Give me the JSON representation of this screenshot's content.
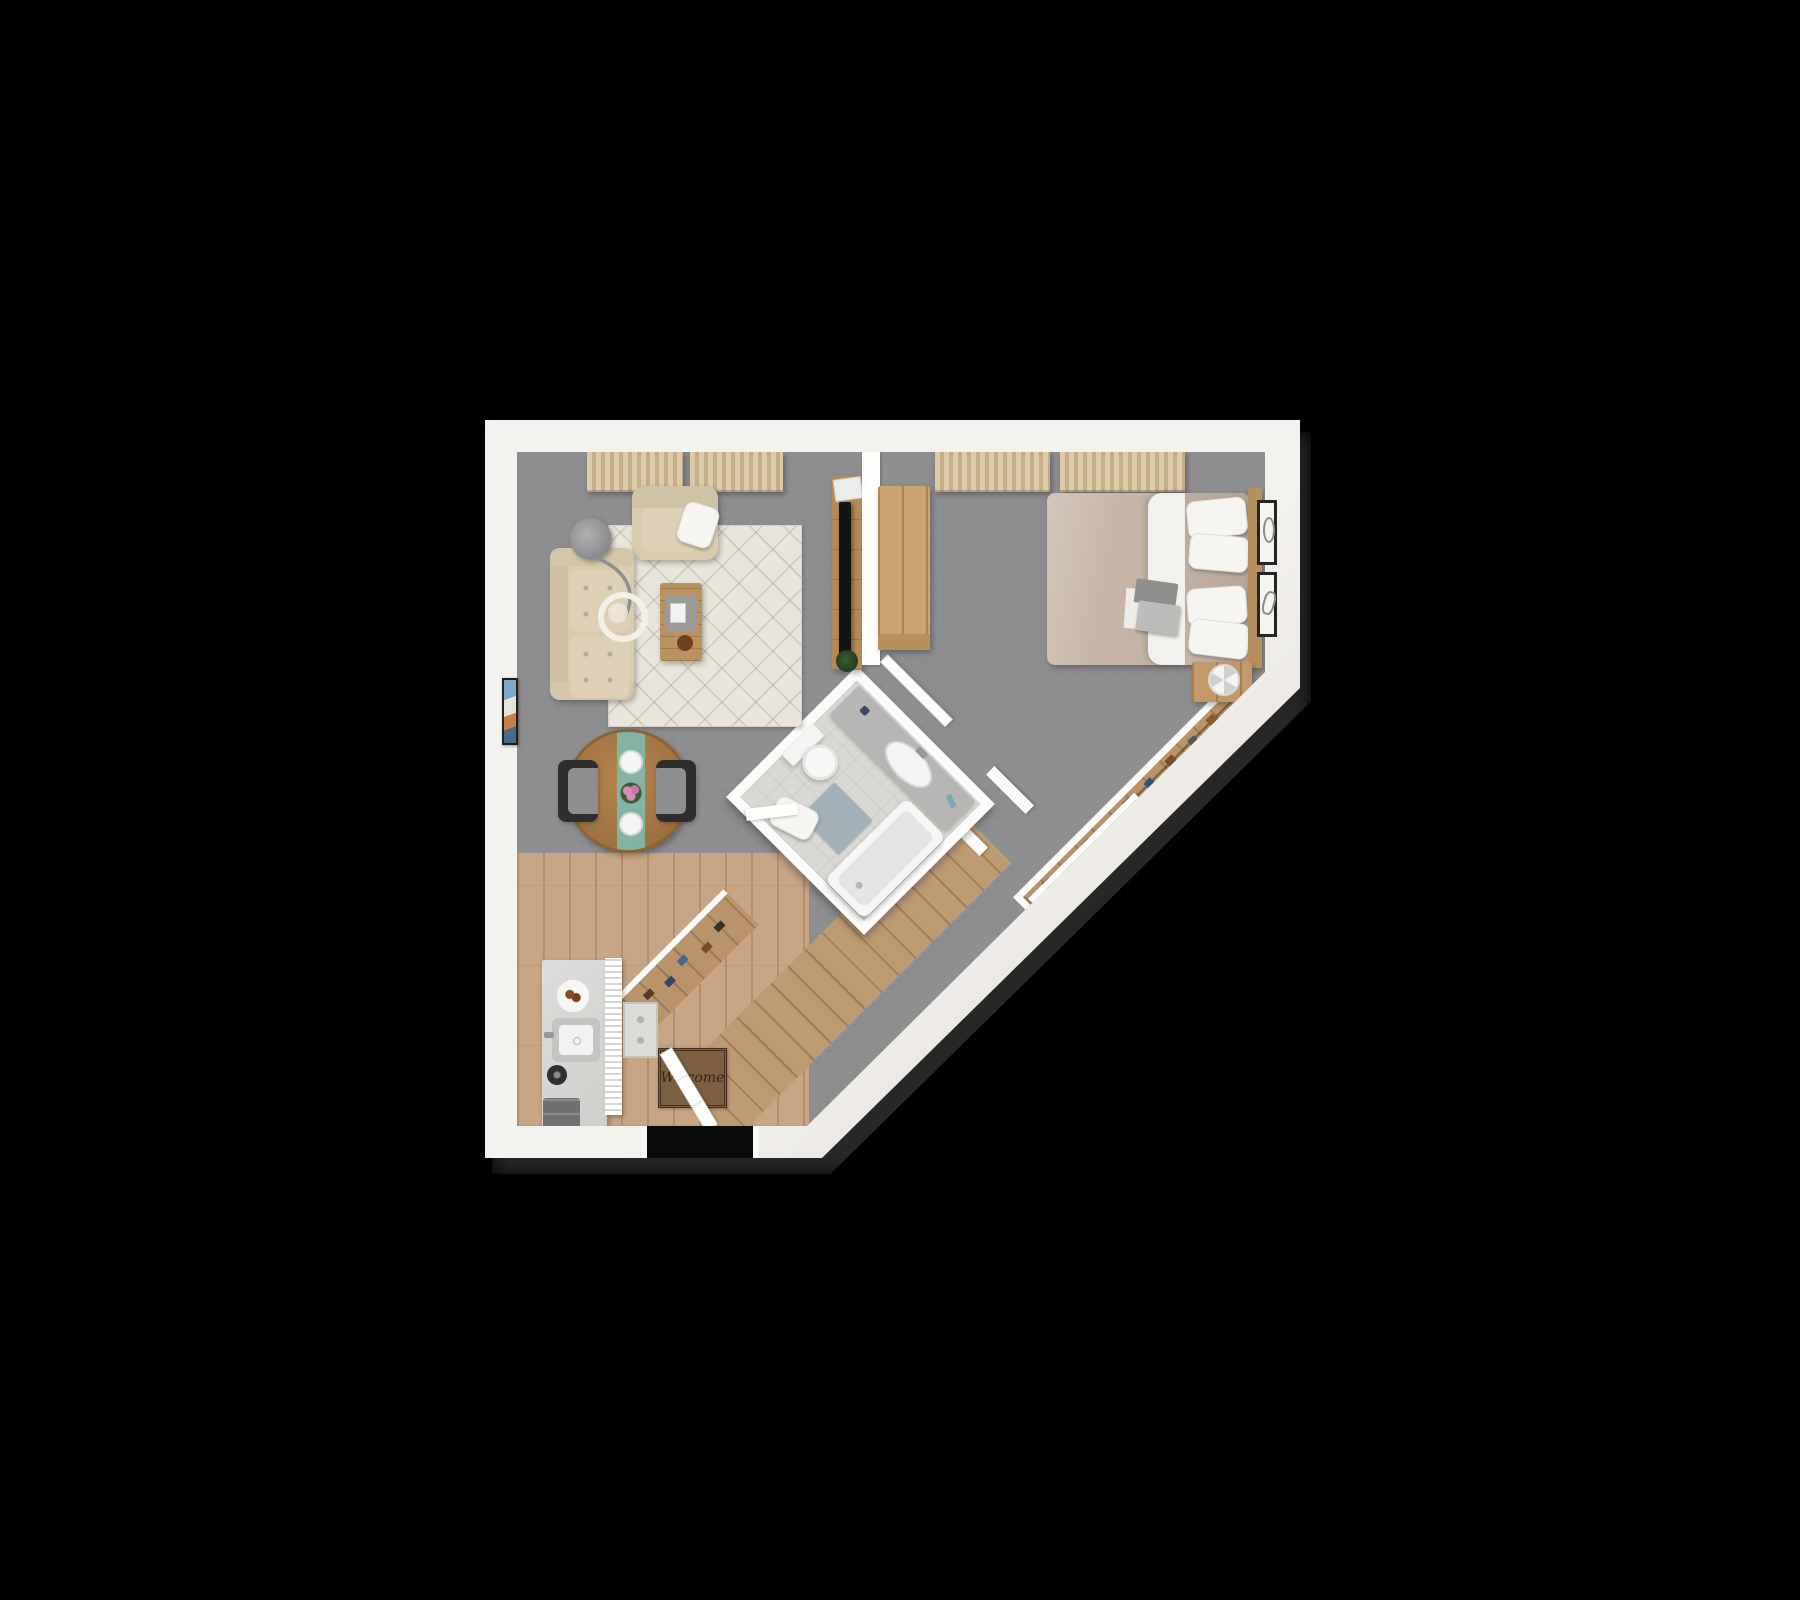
{
  "scene": {
    "type": "3d-floorplan-top-view-render",
    "background_color": "#000000"
  },
  "labels": {
    "welcome_mat": "Welcome"
  },
  "palette": {
    "background": "#000000",
    "exterior_wall": "#f2f0ec",
    "interior_wall": "#fdfdfb",
    "carpet": "#8e8e90",
    "wood_floor": "#c7a585",
    "area_rug": "#e9e5da",
    "sofa": "#d8cbae",
    "curtain": "#d8c5a3",
    "dining_table": "#a97c4a",
    "table_runner": "#7fb9ae",
    "coffee_table": "#b9925f",
    "bed_duvet": "#c6b5a6",
    "pillow": "#f6f5f2",
    "headboard": "#b68f5e",
    "desk": "#c9a46e",
    "closet_wood": "#b9946a",
    "bathroom_tile": "#d9d8d4",
    "bathtub": "#f5f5f3",
    "bath_mat": "#a4b0b8",
    "welcome_mat": "#7d5f42"
  },
  "rooms": [
    {
      "name": "living-room",
      "floor": "carpet",
      "furniture": [
        "sofa",
        "armchair",
        "throw-pillow",
        "floor-lamp",
        "area-rug",
        "coffee-table",
        "tv-console",
        "tv",
        "plant",
        "dining-table",
        "dining-chairs",
        "table-runner",
        "place-settings",
        "flowers",
        "curtains",
        "wall-art"
      ]
    },
    {
      "name": "bedroom",
      "floor": "carpet",
      "furniture": [
        "double-bed",
        "pillows",
        "duvet",
        "laptop",
        "headboard",
        "nightstand",
        "fan",
        "desk",
        "curtains",
        "wall-art-frames"
      ]
    },
    {
      "name": "bathroom",
      "floor": "tile",
      "furniture": [
        "vanity-sink",
        "toilet",
        "bathtub",
        "bath-mat",
        "towel",
        "door"
      ]
    },
    {
      "name": "kitchen-entry",
      "floor": "wood",
      "furniture": [
        "kitchen-counter",
        "sink",
        "kettle",
        "plate-of-cookies",
        "trash-drawers",
        "slatted-cabinet",
        "small-rug",
        "welcome-mat",
        "entry-door"
      ]
    },
    {
      "name": "hallway",
      "floor": "wood",
      "furniture": [
        "shoe-closet"
      ]
    },
    {
      "name": "walk-in-closet",
      "floor": "wood",
      "furniture": [
        "hanging-clothes",
        "sliding-door"
      ]
    }
  ]
}
